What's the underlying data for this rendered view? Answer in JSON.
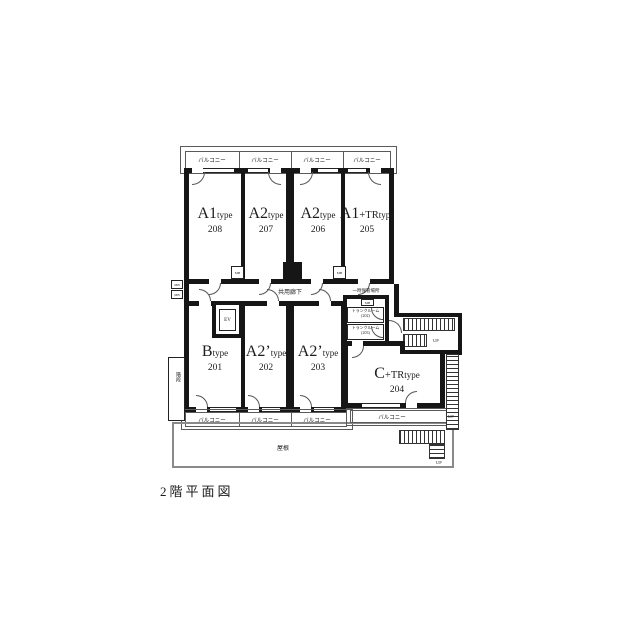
{
  "title": "2階平面図",
  "labels": {
    "balcony": "バルコニー",
    "corridor": "共用廊下",
    "elevator": "EV",
    "meter_box": "MB",
    "storage": "一時保管場所",
    "stairs": "階段",
    "roof": "屋根",
    "up": "UP"
  },
  "units": {
    "top_row": [
      {
        "type_big": "A1",
        "type_mid": "",
        "type_small": "type",
        "number": "208"
      },
      {
        "type_big": "A2",
        "type_mid": "",
        "type_small": "type",
        "number": "207"
      },
      {
        "type_big": "A2",
        "type_mid": "",
        "type_small": "type",
        "number": "206"
      },
      {
        "type_big": "A1",
        "type_mid": "+TR",
        "type_small": "type",
        "number": "205"
      }
    ],
    "bottom_row": [
      {
        "type_big": "B",
        "type_mid": "",
        "type_small": "type",
        "number": "201"
      },
      {
        "type_big": "A2’",
        "type_mid": "",
        "type_small": "type",
        "number": "202"
      },
      {
        "type_big": "A2’",
        "type_mid": "",
        "type_small": "type",
        "number": "203"
      },
      {
        "type_big": "C",
        "type_mid": "+TR",
        "type_small": "type",
        "number": "204"
      }
    ]
  },
  "trunk_rooms": [
    {
      "name": "トランクルーム",
      "number": "(202)"
    },
    {
      "name": "トランクルーム",
      "number": "(203)"
    }
  ],
  "colors": {
    "wall": "#161616",
    "line": "#5a5a5a",
    "roof_outline": "#8a8a8a"
  }
}
